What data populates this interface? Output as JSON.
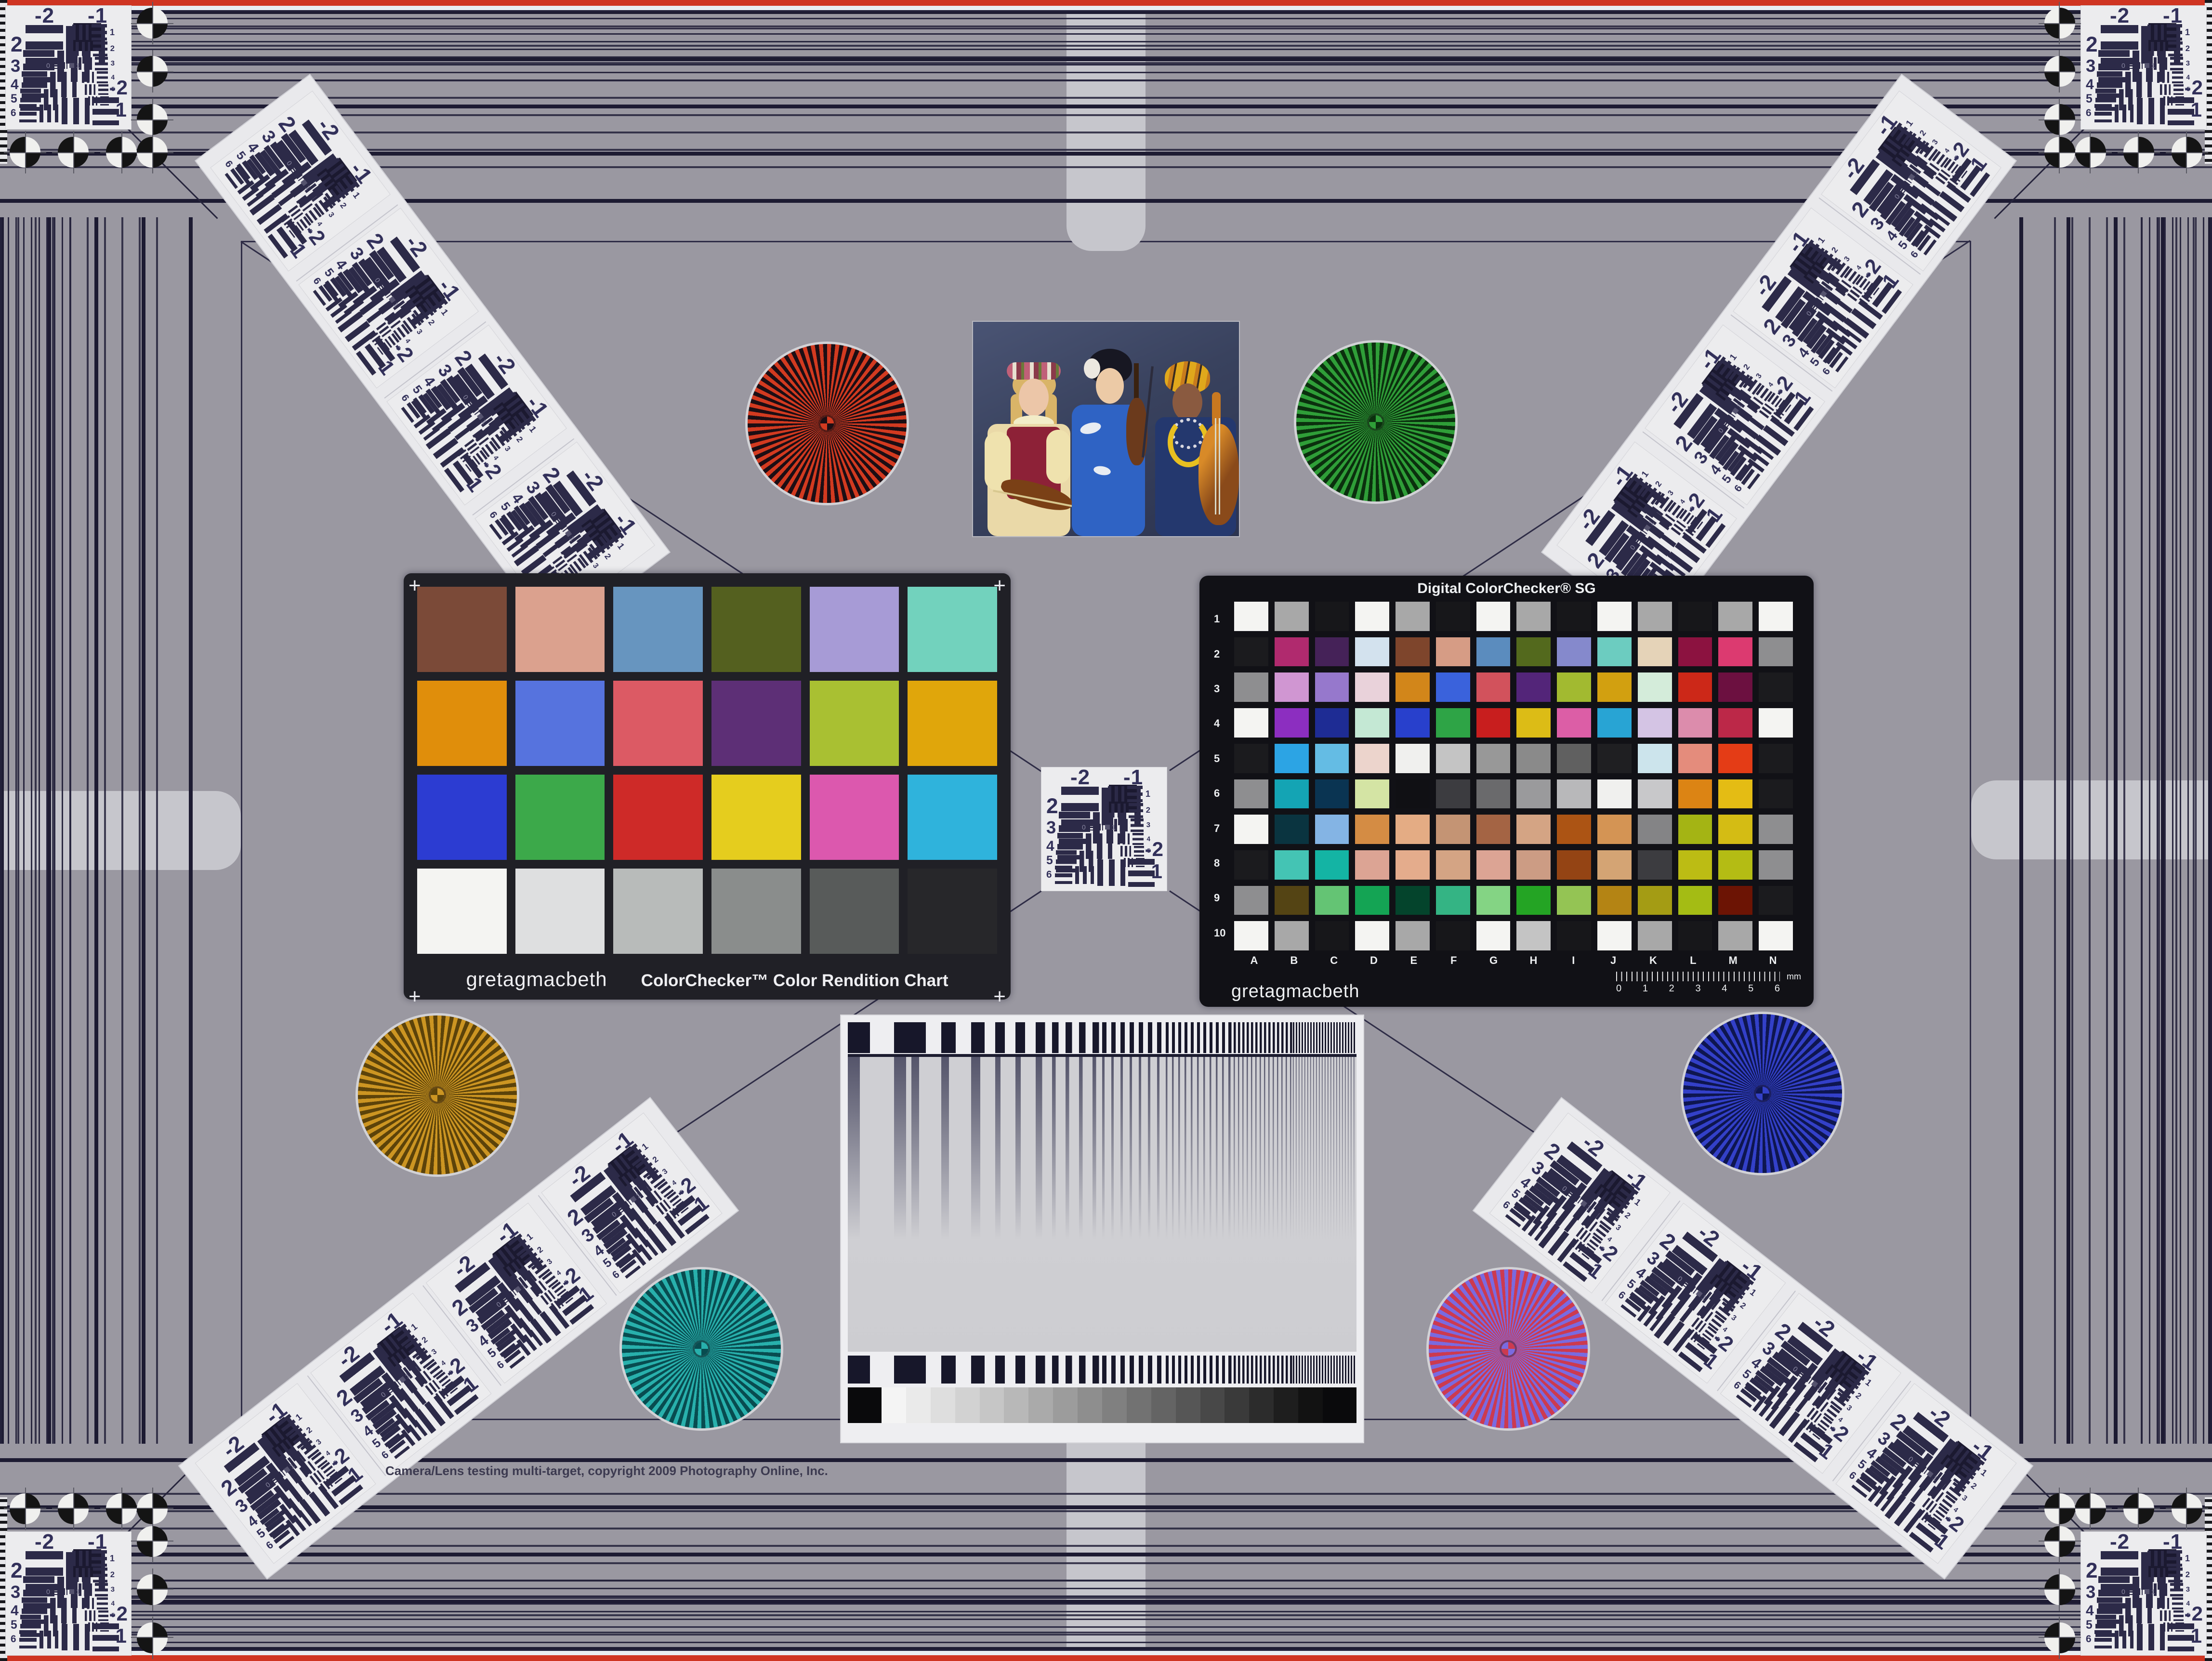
{
  "page": {
    "background": "#9a98a1",
    "copyright": "Camera/Lens testing multi-target, copyright 2009 Photography Online, Inc.",
    "edge_line_color": "#cf3522",
    "border_line_color": "#26243c"
  },
  "usaf": {
    "top_left": "-2",
    "top_right": "-1",
    "left_numbers": [
      "2",
      "3",
      "4",
      "5",
      "6"
    ],
    "right_numbers": [
      "1",
      "2",
      "3",
      "4",
      "5",
      "6"
    ],
    "bottom_right_group": "-2",
    "bottom_right_sub": "1",
    "inner_left": "0",
    "inner_right": "1"
  },
  "classic_chart": {
    "brand": "gretagmacbeth",
    "title": "ColorChecker™ Color Rendition Chart",
    "corner_mark": "+",
    "patches": [
      "#7b4a38",
      "#dba18e",
      "#6795bf",
      "#54601f",
      "#a79bd6",
      "#72d2bd",
      "#e08e0b",
      "#5673de",
      "#dc5a64",
      "#5d2f76",
      "#a9c032",
      "#e0a60b",
      "#2c3cd2",
      "#3ca94a",
      "#ce2a28",
      "#e5cd1e",
      "#dc58ae",
      "#2fb3dc",
      "#f4f4f2",
      "#dedfe0",
      "#b8bbba",
      "#8a8d8c",
      "#585b5a",
      "#27272a"
    ]
  },
  "sg_chart": {
    "title": "Digital ColorChecker® SG",
    "brand": "gretagmacbeth",
    "row_labels": [
      "1",
      "2",
      "3",
      "4",
      "5",
      "6",
      "7",
      "8",
      "9",
      "10"
    ],
    "col_labels": [
      "A",
      "B",
      "C",
      "D",
      "E",
      "F",
      "G",
      "H",
      "I",
      "J",
      "K",
      "L",
      "M",
      "N"
    ],
    "ruler_numbers": [
      "0",
      "1",
      "2",
      "3",
      "4",
      "5",
      "6"
    ],
    "ruler_unit": "mm",
    "rows": [
      [
        "#f4f4f2",
        "#a8a8a8",
        "#17171a",
        "#f4f4f2",
        "#a8a8a8",
        "#17171a",
        "#f4f4f2",
        "#a8a8a8",
        "#17171a",
        "#f4f4f2",
        "#a8a8a8",
        "#17171a",
        "#a8a8a8",
        "#f4f4f2"
      ],
      [
        "#1b1b1e",
        "#b02a6e",
        "#452258",
        "#d3e2ee",
        "#7e452c",
        "#d69c85",
        "#5b8cbe",
        "#53691d",
        "#8589cc",
        "#6cccc0",
        "#e5d3b8",
        "#8c1240",
        "#dc3a70",
        "#8e8e90"
      ],
      [
        "#8e8e90",
        "#d096d2",
        "#9678cc",
        "#e9d2da",
        "#d2861a",
        "#3a62dc",
        "#d2525c",
        "#532579",
        "#a2ba30",
        "#d2a010",
        "#d4ecda",
        "#cc2818",
        "#6c1040",
        "#1b1b1e"
      ],
      [
        "#f4f4f2",
        "#8c2ec0",
        "#1e2c94",
        "#c4e8d4",
        "#2840cc",
        "#2ea446",
        "#c81e1e",
        "#dcbc16",
        "#dc5ea6",
        "#28a4d4",
        "#d4c4e4",
        "#dc8cac",
        "#bc2848",
        "#f4f4f2"
      ],
      [
        "#1b1b1e",
        "#2ca4e4",
        "#64bce4",
        "#ecd4cc",
        "#f0f0ee",
        "#c4c4c4",
        "#989898",
        "#8a8a8a",
        "#606060",
        "#1f1f22",
        "#cce4ec",
        "#e48c7c",
        "#e43c16",
        "#1b1b1e"
      ],
      [
        "#8e8e90",
        "#14a4b4",
        "#0a3452",
        "#d4e4a4",
        "#101014",
        "#3c3c40",
        "#6a6a6c",
        "#9a9a9c",
        "#b8b8ba",
        "#f0f0ee",
        "#c8c8ca",
        "#dc8414",
        "#e4bc14",
        "#1b1b1e"
      ],
      [
        "#f4f4f2",
        "#0a3440",
        "#84b4e4",
        "#d48c44",
        "#e4ac84",
        "#c49474",
        "#a46444",
        "#d4a484",
        "#ac5414",
        "#d49454",
        "#848486",
        "#a4b414",
        "#d4bc14",
        "#8e8e90"
      ],
      [
        "#1b1b1e",
        "#44c4b4",
        "#14b4a4",
        "#dca494",
        "#e4ac8c",
        "#d4a484",
        "#dca494",
        "#cc9c84",
        "#944414",
        "#d4a474",
        "#3c3c40",
        "#bcbc14",
        "#b4bc14",
        "#8e8e90"
      ],
      [
        "#8e8e90",
        "#544414",
        "#64c474",
        "#14a454",
        "#04442c",
        "#34b484",
        "#84d484",
        "#24a424",
        "#94c454",
        "#b48414",
        "#a49c14",
        "#a4bc14",
        "#6c1404",
        "#1b1b1e"
      ],
      [
        "#f4f4f2",
        "#a8a8a8",
        "#17171a",
        "#f4f4f2",
        "#a8a8a8",
        "#17171a",
        "#f4f4f2",
        "#c4c4c4",
        "#17171a",
        "#f4f4f2",
        "#a8a8a8",
        "#17171a",
        "#a8a8a8",
        "#f4f4f2"
      ]
    ]
  },
  "stars": [
    {
      "name": "red",
      "color_a": "#d23a20",
      "color_b": "#1c0e14"
    },
    {
      "name": "green",
      "color_a": "#2f9e38",
      "color_b": "#0b300e"
    },
    {
      "name": "gold",
      "color_a": "#cc9522",
      "color_b": "#5c430a"
    },
    {
      "name": "blue",
      "color_a": "#3340c8",
      "color_b": "#0e1650"
    },
    {
      "name": "teal",
      "color_a": "#28b0ac",
      "color_b": "#084c50"
    },
    {
      "name": "red-blue",
      "color_a": "#cc3a50",
      "color_b": "#7a6ae0"
    }
  ],
  "sweep_target": {
    "gray_steps": [
      "#f4f4f4",
      "#eaeaea",
      "#dedede",
      "#d2d2d2",
      "#c6c6c6",
      "#b8b8b8",
      "#aaaaaa",
      "#9c9c9c",
      "#8e8e8e",
      "#808080",
      "#727272",
      "#646464",
      "#565656",
      "#484848",
      "#3a3a3a",
      "#2c2c2c",
      "#1e1e1e",
      "#121212"
    ]
  },
  "photo": {
    "backdrop": "#39425e",
    "palette": {
      "blonde_hair": "#d9b468",
      "skin_light": "#ecc6a8",
      "skin_dark": "#8a5a40",
      "yellow_blouse": "#efe2ae",
      "red_vest": "#8d2137",
      "blue_kimono": "#2f63c4",
      "black_hair": "#171722",
      "turban_yellow": "#e0a81c",
      "navy_dress": "#24386e",
      "violin_wood": "#7a4016",
      "cello_wood": "#8a4a1a",
      "necklace_yellow": "#e8c020"
    }
  }
}
